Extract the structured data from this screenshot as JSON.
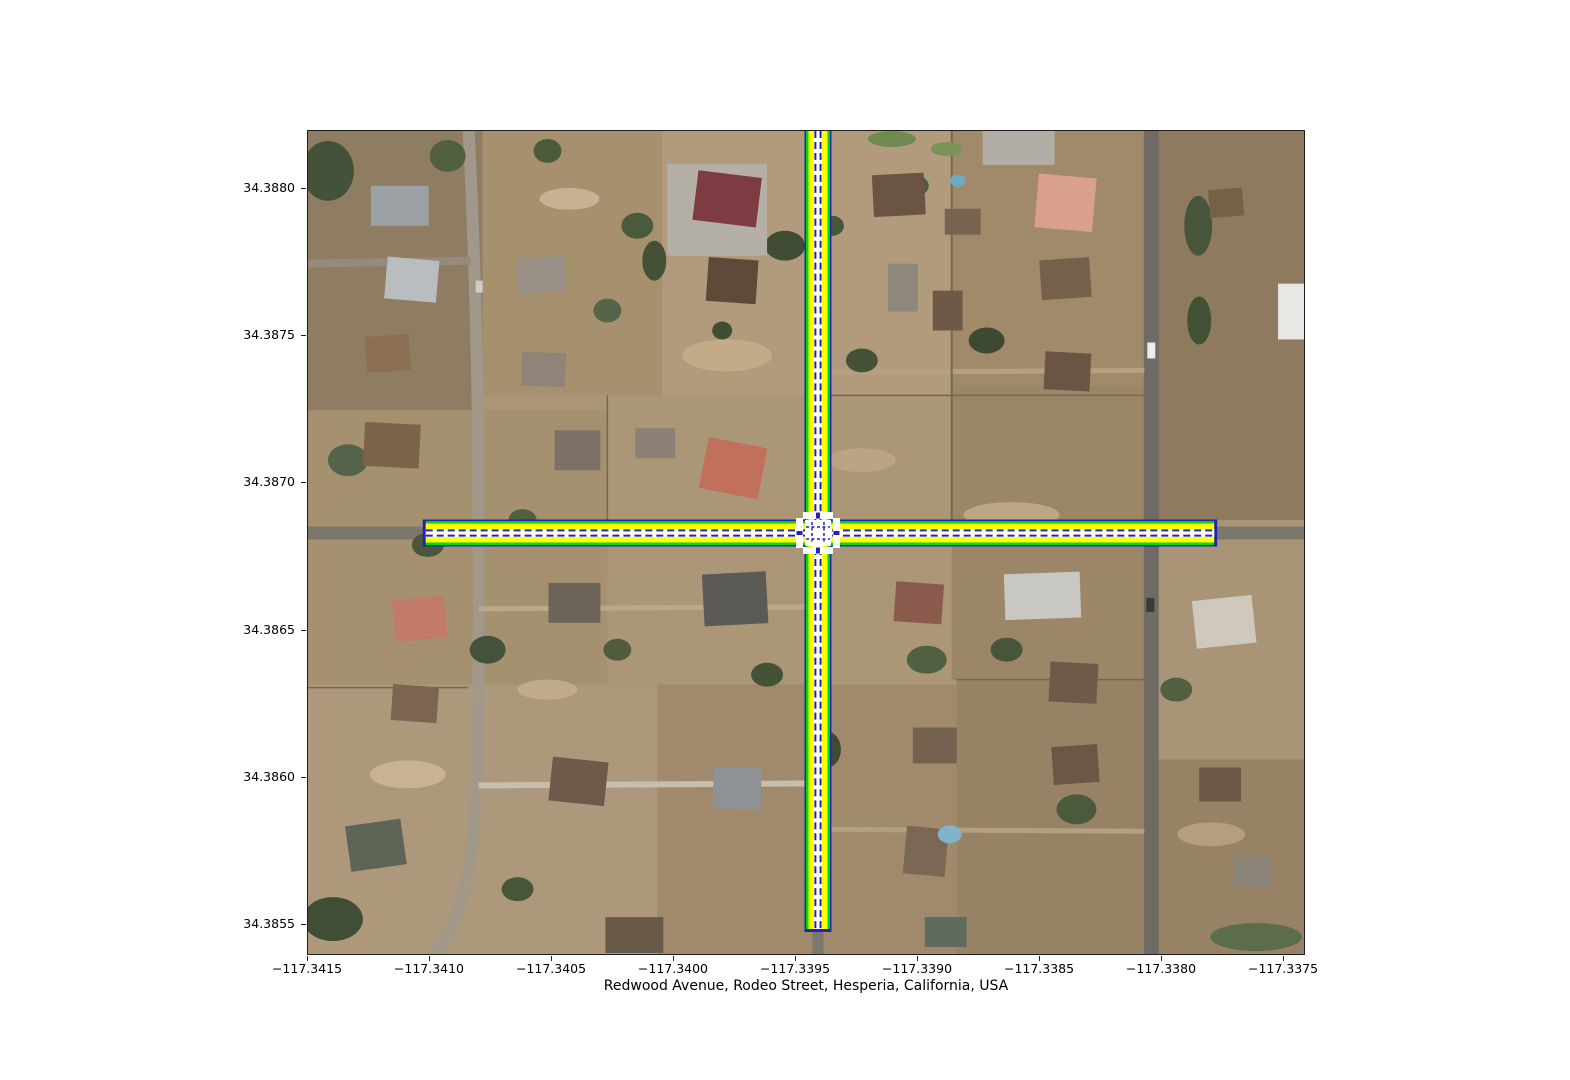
{
  "figure": {
    "xlabel": "Redwood Avenue, Rodeo Street, Hesperia, California, USA"
  },
  "axes": {
    "x_ticks": [
      {
        "label": "−117.3415",
        "pct": 0
      },
      {
        "label": "−117.3410",
        "pct": 12.22
      },
      {
        "label": "−117.3405",
        "pct": 24.45
      },
      {
        "label": "−117.3400",
        "pct": 36.67
      },
      {
        "label": "−117.3395",
        "pct": 48.9
      },
      {
        "label": "−117.3390",
        "pct": 61.12
      },
      {
        "label": "−117.3385",
        "pct": 73.35
      },
      {
        "label": "−117.3380",
        "pct": 85.57
      },
      {
        "label": "−117.3375",
        "pct": 97.8
      }
    ],
    "y_ticks": [
      {
        "label": "34.3880",
        "pct": 7.03
      },
      {
        "label": "34.3875",
        "pct": 24.85
      },
      {
        "label": "34.3870",
        "pct": 42.67
      },
      {
        "label": "34.3865",
        "pct": 60.61
      },
      {
        "label": "34.3860",
        "pct": 78.42
      },
      {
        "label": "34.3855",
        "pct": 96.24
      }
    ]
  },
  "scene": {
    "base_color": "#ab9478",
    "fields": [
      [
        0,
        0,
        175,
        280,
        "#8f7d63"
      ],
      [
        175,
        0,
        180,
        265,
        "#a7906e"
      ],
      [
        355,
        0,
        290,
        270,
        "#b29b7d"
      ],
      [
        645,
        0,
        200,
        255,
        "#a18a69"
      ],
      [
        845,
        0,
        153,
        390,
        "#8e7a5e"
      ],
      [
        0,
        280,
        300,
        275,
        "#a5906f"
      ],
      [
        300,
        265,
        345,
        290,
        "#ac9678"
      ],
      [
        645,
        255,
        200,
        295,
        "#9b8667"
      ],
      [
        0,
        555,
        350,
        270,
        "#ae987b"
      ],
      [
        350,
        555,
        300,
        270,
        "#a18a6b"
      ],
      [
        650,
        550,
        348,
        275,
        "#978266"
      ],
      [
        845,
        390,
        153,
        240,
        "#aa9478"
      ]
    ],
    "patches": [
      [
        420,
        225,
        45,
        16,
        "#c3ab88"
      ],
      [
        100,
        645,
        38,
        14,
        "#c8b292"
      ],
      [
        705,
        385,
        48,
        13,
        "#bda686"
      ],
      [
        262,
        68,
        30,
        11,
        "#c7b192"
      ],
      [
        555,
        330,
        34,
        12,
        "#bba383"
      ],
      [
        240,
        560,
        30,
        10,
        "#c2ab8a"
      ],
      [
        905,
        705,
        34,
        12,
        "#b59d7d"
      ]
    ],
    "paths": [
      {
        "d": "M 0 403 H 998",
        "c": "#7c776d",
        "w": 13
      },
      {
        "d": "M 511 0 V 825",
        "c": "#7c776d",
        "w": 11
      },
      {
        "d": "M 845 0 V 825",
        "c": "#6f6b64",
        "w": 15
      },
      {
        "d": "M 161 0 C 168 140 171 280 171 403 C 171 560 172 650 164 720 C 157 772 144 800 128 825",
        "c": "#a19889",
        "w": 12
      },
      {
        "d": "M 0 133 L 163 130",
        "c": "#958b7a",
        "w": 8
      },
      {
        "d": "M 171 479 L 505 477",
        "c": "#bca887",
        "w": 5
      },
      {
        "d": "M 517 242 L 838 240",
        "c": "#b5a181",
        "w": 5
      },
      {
        "d": "M 517 700 L 838 702",
        "c": "#b3a081",
        "w": 5
      },
      {
        "d": "M 171 656 L 505 654",
        "c": "#c6bfae",
        "w": 6
      },
      {
        "d": "M 645 0 V 398",
        "c": "#77664f",
        "w": 2
      },
      {
        "d": "M 300 265 V 398",
        "c": "#77664f",
        "w": 1.5
      },
      {
        "d": "M 517 265 H 840",
        "c": "#77664f",
        "w": 1.5
      },
      {
        "d": "M 0 558 H 160",
        "c": "#77664f",
        "w": 1.5
      },
      {
        "d": "M 650 550 H 840",
        "c": "#77664f",
        "w": 1.5
      }
    ],
    "buildings": [
      [
        63,
        55,
        58,
        40,
        "#9ba1a5",
        0
      ],
      [
        78,
        128,
        52,
        42,
        "#b9bdbf",
        5
      ],
      [
        58,
        205,
        44,
        36,
        "#8a6f52",
        -4
      ],
      [
        56,
        293,
        56,
        44,
        "#7d6349",
        3
      ],
      [
        210,
        126,
        48,
        36,
        "#999086",
        -2
      ],
      [
        214,
        222,
        44,
        34,
        "#8e8477",
        2
      ],
      [
        247,
        300,
        46,
        40,
        "#7b7265",
        0
      ],
      [
        360,
        33,
        100,
        92,
        "#b5b0a7",
        0
      ],
      [
        388,
        43,
        64,
        50,
        "#7e3b41",
        7
      ],
      [
        400,
        128,
        50,
        44,
        "#5d4a39",
        4
      ],
      [
        396,
        312,
        60,
        52,
        "#c2705e",
        11
      ],
      [
        328,
        298,
        40,
        30,
        "#8b8177",
        0
      ],
      [
        566,
        43,
        52,
        42,
        "#6b5443",
        -3
      ],
      [
        638,
        78,
        36,
        26,
        "#7a6350",
        0
      ],
      [
        581,
        133,
        30,
        48,
        "#8f877b",
        0
      ],
      [
        626,
        160,
        30,
        40,
        "#6e5947",
        0
      ],
      [
        730,
        45,
        58,
        54,
        "#d9a08c",
        5
      ],
      [
        734,
        128,
        50,
        40,
        "#75604c",
        -4
      ],
      [
        738,
        222,
        46,
        38,
        "#6a5545",
        3
      ],
      [
        676,
        0,
        72,
        34,
        "#b2ada5",
        0
      ],
      [
        972,
        153,
        26,
        56,
        "#e9e7e3",
        0
      ],
      [
        903,
        58,
        34,
        28,
        "#756146",
        -5
      ],
      [
        86,
        468,
        52,
        42,
        "#c27b69",
        -6
      ],
      [
        84,
        556,
        46,
        36,
        "#7c6450",
        4
      ],
      [
        40,
        693,
        56,
        46,
        "#5e6556",
        -8
      ],
      [
        241,
        453,
        52,
        40,
        "#6d6459",
        0
      ],
      [
        243,
        630,
        56,
        44,
        "#70584a",
        6
      ],
      [
        396,
        443,
        64,
        52,
        "#5c5a55",
        -3
      ],
      [
        406,
        638,
        48,
        42,
        "#8e9296",
        2
      ],
      [
        298,
        788,
        58,
        36,
        "#6a5a4a",
        0
      ],
      [
        588,
        453,
        48,
        40,
        "#8a5b4d",
        4
      ],
      [
        698,
        443,
        76,
        46,
        "#c9c7c2",
        -2
      ],
      [
        743,
        533,
        48,
        40,
        "#6e5a49",
        3
      ],
      [
        746,
        616,
        46,
        38,
        "#6b5746",
        -4
      ],
      [
        606,
        598,
        44,
        36,
        "#74614f",
        0
      ],
      [
        598,
        698,
        42,
        48,
        "#7b6854",
        5
      ],
      [
        888,
        468,
        60,
        48,
        "#cfc9bd",
        -6
      ],
      [
        893,
        638,
        42,
        34,
        "#6d5949",
        0
      ],
      [
        928,
        728,
        36,
        30,
        "#8a8478",
        4
      ],
      [
        618,
        788,
        42,
        30,
        "#5f6b5e",
        0
      ]
    ],
    "pools": [
      [
        643,
        705,
        12,
        9,
        "#7fb4c9"
      ],
      [
        651,
        50,
        8,
        6,
        "#6fa9c2"
      ]
    ],
    "vegetation": [
      [
        20,
        40,
        26,
        30,
        "#45523a"
      ],
      [
        140,
        25,
        18,
        16,
        "#51603f"
      ],
      [
        330,
        95,
        16,
        13,
        "#4c5a3c"
      ],
      [
        300,
        180,
        14,
        12,
        "#56644a"
      ],
      [
        478,
        115,
        20,
        15,
        "#3f4c33"
      ],
      [
        525,
        95,
        12,
        10,
        "#475538"
      ],
      [
        610,
        55,
        12,
        10,
        "#4e5c3e"
      ],
      [
        555,
        230,
        16,
        12,
        "#455238"
      ],
      [
        680,
        210,
        18,
        13,
        "#3d4a31"
      ],
      [
        892,
        95,
        14,
        30,
        "#47553a"
      ],
      [
        893,
        190,
        12,
        24,
        "#425036"
      ],
      [
        40,
        330,
        20,
        16,
        "#55634a"
      ],
      [
        120,
        415,
        16,
        12,
        "#4a5839"
      ],
      [
        215,
        390,
        14,
        11,
        "#515f40"
      ],
      [
        180,
        520,
        18,
        14,
        "#45533a"
      ],
      [
        310,
        520,
        14,
        11,
        "#4f5d3e"
      ],
      [
        460,
        545,
        16,
        12,
        "#445236"
      ],
      [
        520,
        620,
        14,
        18,
        "#3e4c32"
      ],
      [
        620,
        530,
        20,
        14,
        "#526042"
      ],
      [
        700,
        520,
        16,
        12,
        "#475539"
      ],
      [
        770,
        680,
        20,
        15,
        "#4b5a3c"
      ],
      [
        870,
        560,
        16,
        12,
        "#506040"
      ],
      [
        950,
        808,
        46,
        14,
        "#5d6c49"
      ],
      [
        25,
        790,
        30,
        22,
        "#3f4e35"
      ],
      [
        210,
        760,
        16,
        12,
        "#485638"
      ],
      [
        585,
        8,
        24,
        8,
        "#6f8a4f"
      ],
      [
        640,
        18,
        16,
        7,
        "#7a9455"
      ],
      [
        347,
        130,
        12,
        20,
        "#445136"
      ],
      [
        240,
        20,
        14,
        12,
        "#4d5b3d"
      ],
      [
        415,
        200,
        10,
        9,
        "#3f4d33"
      ]
    ],
    "vehicles": [
      [
        841,
        212,
        8,
        16,
        "#ededea"
      ],
      [
        840,
        468,
        8,
        14,
        "#3a3a3a"
      ],
      [
        505,
        560,
        7,
        12,
        "#d8d6d2"
      ],
      [
        168,
        150,
        7,
        12,
        "#cccccc"
      ]
    ]
  },
  "network": {
    "colors": {
      "blue": "#2222bb",
      "green": "#00d900",
      "yellow": "#ffff00",
      "white": "#ffffff"
    },
    "layers": [
      {
        "c": "blue",
        "w": 27,
        "ext": 3
      },
      {
        "c": "green",
        "w": 24,
        "ext": 0
      },
      {
        "c": "yellow",
        "w": 19,
        "ext": 0
      },
      {
        "c": "white",
        "w": 8,
        "ext": 0
      }
    ],
    "center_dash": {
      "c": "blue",
      "w": 2,
      "offset": 2.6,
      "dash": "7 4"
    },
    "h_road": {
      "x1": 118,
      "x2": 908,
      "y": 403
    },
    "v_road": {
      "x": 511,
      "y1": 0,
      "y2": 800
    },
    "junction": {
      "cx": 511,
      "cy": 403,
      "size": 26,
      "inner_dashes": [
        [
          505,
          392,
          505,
          414
        ],
        [
          517,
          392,
          517,
          414
        ],
        [
          499,
          397,
          523,
          397
        ],
        [
          499,
          409,
          523,
          409
        ]
      ]
    },
    "stop_bars": [
      {
        "x": 511,
        "y": 385.5,
        "o": "h"
      },
      {
        "x": 511,
        "y": 420.5,
        "o": "h"
      },
      {
        "x": 492.5,
        "y": 403,
        "o": "v"
      },
      {
        "x": 529.5,
        "y": 403,
        "o": "v"
      }
    ]
  }
}
